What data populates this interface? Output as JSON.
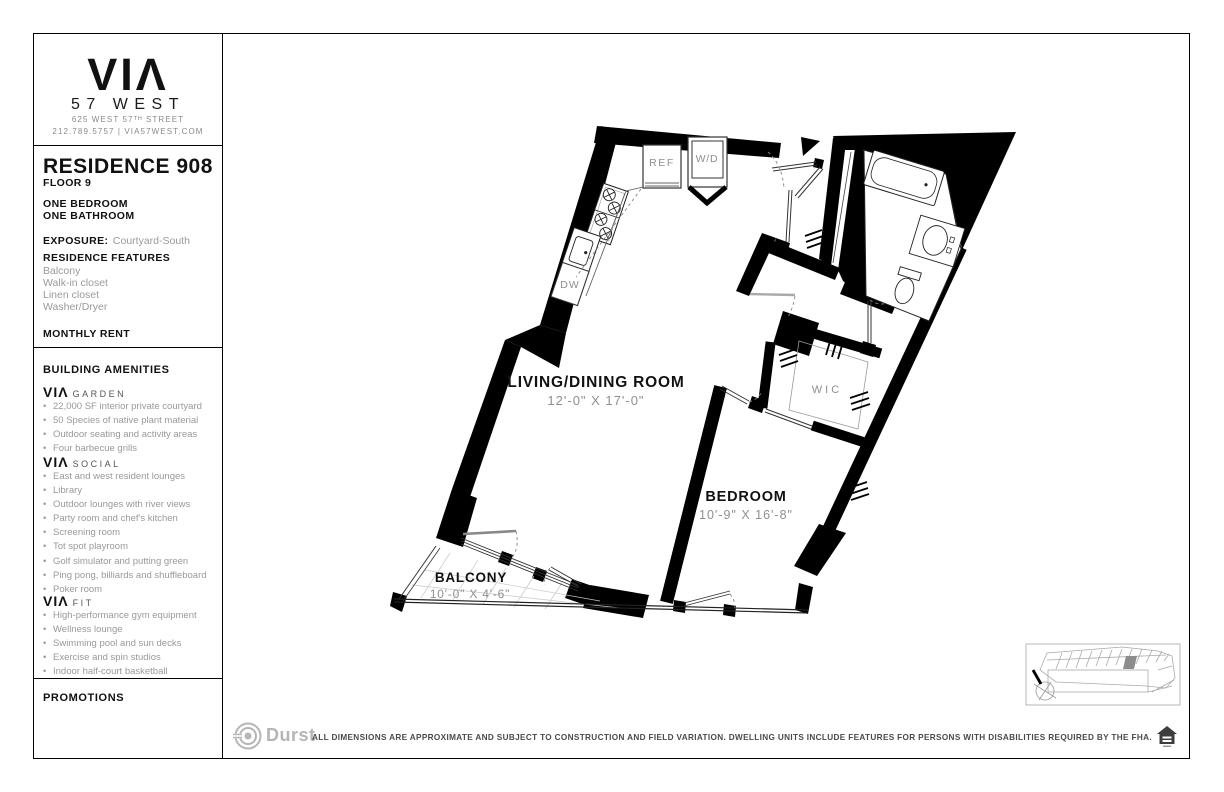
{
  "colors": {
    "wall": "#000000",
    "label_gray": "#8f8f8f",
    "light_gray": "#b5b5b5",
    "text_gray": "#999999",
    "ink": "#111111"
  },
  "sidebar": {
    "logo": {
      "wordmark": "VIΛ",
      "sub": "57 WEST",
      "address": "625 WEST 57ᵀᴴ STREET",
      "contact": "212.789.5757 | VIA57WEST.COM"
    },
    "residence": {
      "title": "RESIDENCE 908",
      "floor": "FLOOR 9",
      "bed": "ONE BEDROOM",
      "bath": "ONE BATHROOM",
      "exposure_label": "EXPOSURE:",
      "exposure_value": "Courtyard-South",
      "features_label": "RESIDENCE FEATURES",
      "features": [
        "Balcony",
        "Walk-in closet",
        "Linen closet",
        "Washer/Dryer"
      ],
      "rent_label": "MONTHLY RENT"
    },
    "amenities": {
      "title": "BUILDING AMENITIES",
      "groups": [
        {
          "brand": "VIΛ",
          "name": "GARDEN",
          "items": [
            "22,000 SF interior private courtyard",
            "50 Species of native plant material",
            "Outdoor seating and activity areas",
            "Four barbecue grills"
          ]
        },
        {
          "brand": "VIΛ",
          "name": "SOCIAL",
          "items": [
            "East and west resident lounges",
            "Library",
            "Outdoor lounges with river views",
            "Party room and chef's kitchen",
            "Screening room",
            "Tot spot playroom",
            "Golf simulator and putting green",
            "Ping pong, billiards and shuffleboard",
            "Poker room"
          ]
        },
        {
          "brand": "VIΛ",
          "name": "FIT",
          "items": [
            "High-performance gym equipment",
            "Wellness lounge",
            "Swimming pool and sun decks",
            "Exercise and spin studios",
            "Indoor half-court basketball"
          ]
        }
      ]
    },
    "promotions_label": "PROMOTIONS"
  },
  "plan": {
    "rooms": [
      {
        "name": "LIVING/DINING ROOM",
        "dims": "12'-0\" X 17'-0\""
      },
      {
        "name": "BEDROOM",
        "dims": "10'-9\" X 16'-8\""
      },
      {
        "name": "BALCONY",
        "dims": "10'-0\" X 4'-6\""
      }
    ],
    "closet_label": "WIC",
    "appliances": {
      "ref": "REF",
      "wd": "W/D",
      "dw": "DW"
    }
  },
  "footer": {
    "brand": "Durst",
    "disclaimer": "ALL DIMENSIONS ARE APPROXIMATE AND SUBJECT TO CONSTRUCTION AND FIELD VARIATION.  DWELLING UNITS INCLUDE FEATURES FOR PERSONS WITH DISABILITIES REQUIRED BY THE FHA."
  }
}
